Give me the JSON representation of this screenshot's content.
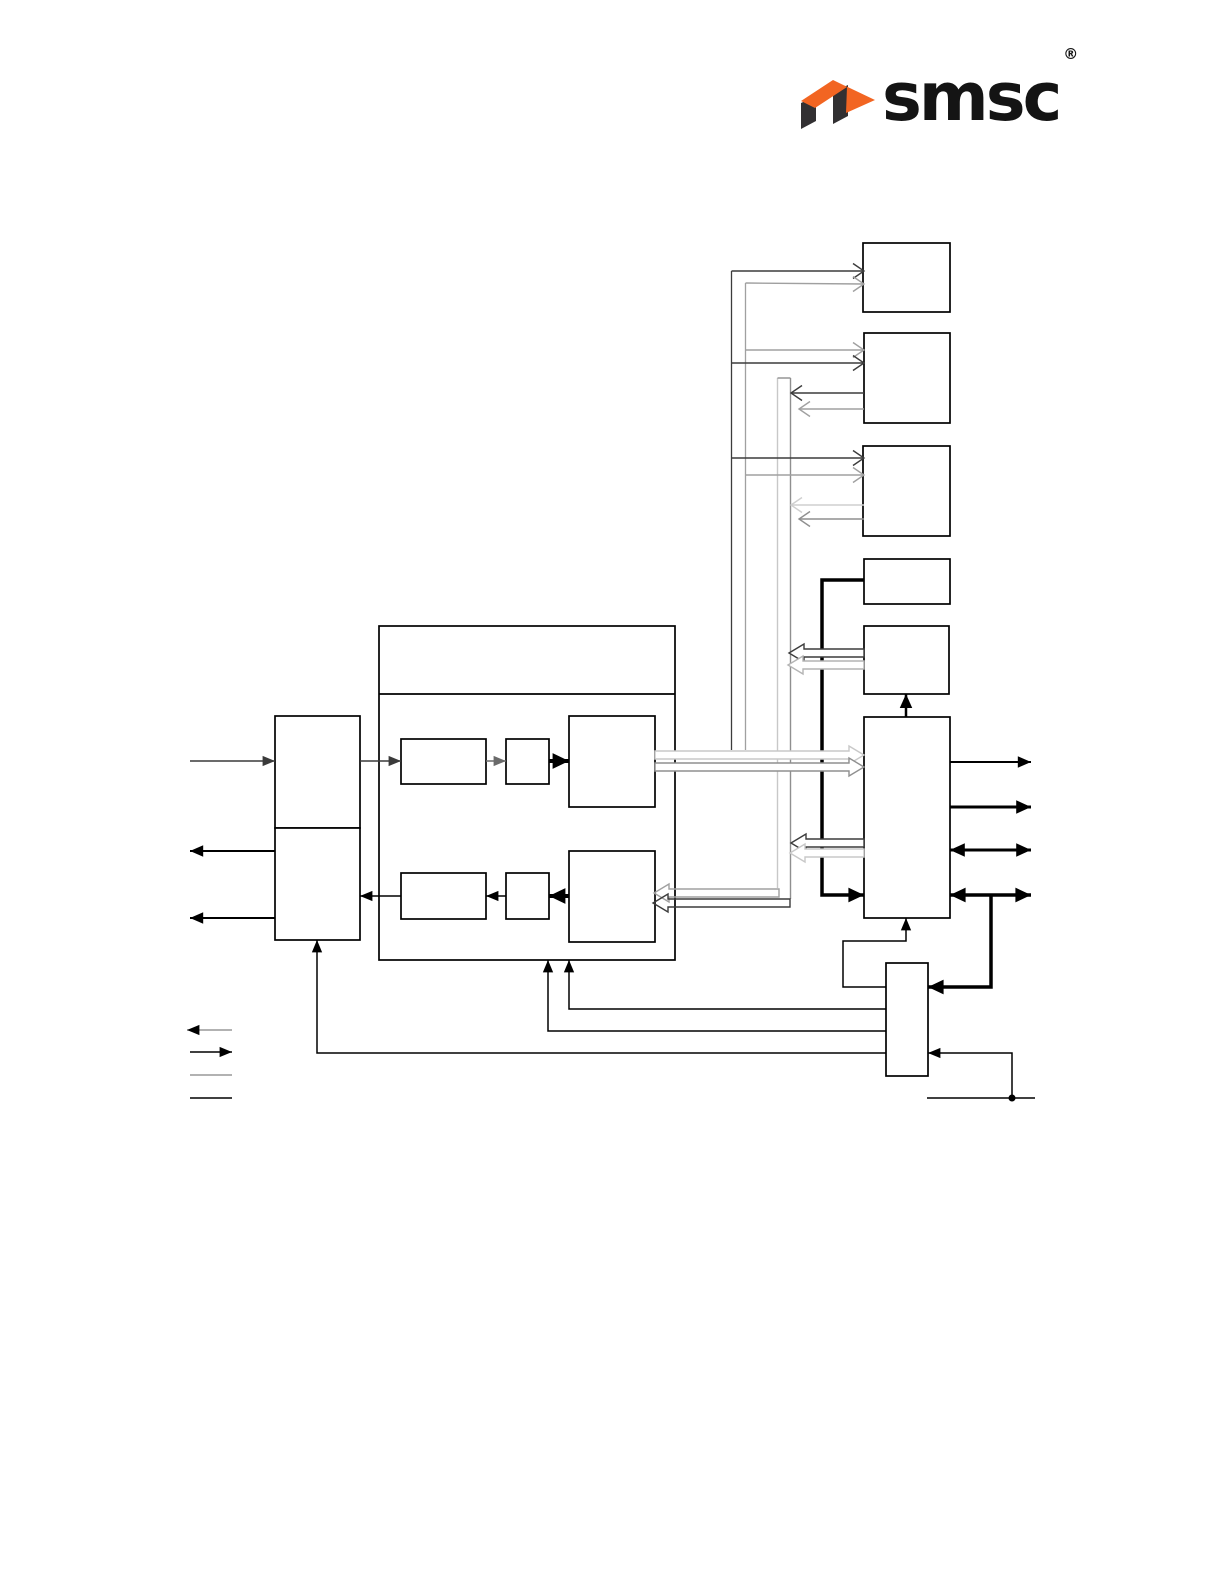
{
  "logo": {
    "text": "smsc",
    "registered": "®",
    "colors": {
      "orange": "#F26522",
      "dark": "#323032",
      "text": "#141414"
    }
  },
  "diagram": {
    "stroke_default": "#000000",
    "boxes": [
      {
        "name": "peripheral-box-1",
        "x": 863,
        "y": 243,
        "w": 87,
        "h": 69
      },
      {
        "name": "peripheral-box-2",
        "x": 864,
        "y": 333,
        "w": 86,
        "h": 90
      },
      {
        "name": "peripheral-box-3",
        "x": 863,
        "y": 446,
        "w": 87,
        "h": 90
      },
      {
        "name": "small-box-1",
        "x": 864,
        "y": 559,
        "w": 86,
        "h": 45
      },
      {
        "name": "small-box-2",
        "x": 864,
        "y": 626,
        "w": 85,
        "h": 68
      },
      {
        "name": "tall-controller-box",
        "x": 864,
        "y": 717,
        "w": 86,
        "h": 201
      },
      {
        "name": "bottom-controller-box",
        "x": 886,
        "y": 963,
        "w": 42,
        "h": 113
      },
      {
        "name": "left-upper-box",
        "x": 275,
        "y": 716,
        "w": 85,
        "h": 112
      },
      {
        "name": "left-lower-box",
        "x": 275,
        "y": 828,
        "w": 85,
        "h": 112
      },
      {
        "name": "center-block",
        "x": 379,
        "y": 626,
        "w": 296,
        "h": 334
      },
      {
        "name": "sub-box-a",
        "x": 401,
        "y": 739,
        "w": 85,
        "h": 45
      },
      {
        "name": "sub-box-b",
        "x": 506,
        "y": 739,
        "w": 43,
        "h": 45
      },
      {
        "name": "sub-box-c",
        "x": 569,
        "y": 716,
        "w": 86,
        "h": 91
      },
      {
        "name": "sub-box-d",
        "x": 401,
        "y": 873,
        "w": 85,
        "h": 46
      },
      {
        "name": "sub-box-e",
        "x": 506,
        "y": 873,
        "w": 43,
        "h": 46
      },
      {
        "name": "sub-box-f",
        "x": 569,
        "y": 851,
        "w": 86,
        "h": 91
      }
    ],
    "lines": [
      {
        "name": "center-title-divider",
        "pts": [
          [
            379,
            694
          ],
          [
            675,
            694
          ]
        ],
        "w": 1.7,
        "head": "none"
      },
      {
        "name": "left-input-arrow",
        "pts": [
          [
            190,
            761
          ],
          [
            275,
            761
          ]
        ],
        "w": 1.5,
        "color": "#3a3a3a",
        "head": "end"
      },
      {
        "name": "left-output-arrow-1",
        "pts": [
          [
            275,
            851
          ],
          [
            190,
            851
          ]
        ],
        "w": 2,
        "head": "end"
      },
      {
        "name": "left-output-arrow-2",
        "pts": [
          [
            275,
            918
          ],
          [
            190,
            918
          ]
        ],
        "w": 2,
        "head": "end"
      },
      {
        "name": "into-sub-a-arrow",
        "pts": [
          [
            360,
            761
          ],
          [
            401,
            761
          ]
        ],
        "w": 1.5,
        "color": "#3a3a3a",
        "head": "end"
      },
      {
        "name": "a-to-b-arrow",
        "pts": [
          [
            486,
            761
          ],
          [
            506,
            761
          ]
        ],
        "w": 1.5,
        "color": "#6a6a6a",
        "head": "end"
      },
      {
        "name": "b-to-c-arrow",
        "pts": [
          [
            549,
            761
          ],
          [
            569,
            761
          ]
        ],
        "w": 4,
        "head": "end"
      },
      {
        "name": "f-to-e-arrow",
        "pts": [
          [
            569,
            896
          ],
          [
            549,
            896
          ]
        ],
        "w": 4,
        "head": "end"
      },
      {
        "name": "e-to-d-arrow",
        "pts": [
          [
            506,
            896
          ],
          [
            486,
            896
          ]
        ],
        "w": 1.5,
        "head": "end"
      },
      {
        "name": "d-to-left-lower-arrow",
        "pts": [
          [
            401,
            896
          ],
          [
            360,
            896
          ]
        ],
        "w": 1.5,
        "head": "end"
      },
      {
        "name": "thick-feed-line",
        "pts": [
          [
            864,
            580
          ],
          [
            822,
            580
          ],
          [
            822,
            895
          ],
          [
            864,
            895
          ]
        ],
        "w": 3.5,
        "head": "end"
      },
      {
        "name": "tall-to-small-box-2-arrow",
        "pts": [
          [
            906,
            717
          ],
          [
            906,
            694
          ]
        ],
        "w": 2.5,
        "head": "end"
      },
      {
        "name": "bottom-to-tall-feed",
        "pts": [
          [
            886,
            987
          ],
          [
            843,
            987
          ],
          [
            843,
            941
          ],
          [
            906,
            941
          ],
          [
            906,
            918
          ]
        ],
        "w": 1.5,
        "head": "end"
      },
      {
        "name": "bottom-to-center-feed-1",
        "pts": [
          [
            886,
            1009
          ],
          [
            569,
            1009
          ],
          [
            569,
            960
          ]
        ],
        "w": 1.5,
        "head": "end"
      },
      {
        "name": "bottom-to-center-feed-2",
        "pts": [
          [
            886,
            1031
          ],
          [
            548,
            1031
          ],
          [
            548,
            960
          ]
        ],
        "w": 1.5,
        "head": "end"
      },
      {
        "name": "bottom-to-left-lower-feed",
        "pts": [
          [
            886,
            1053
          ],
          [
            317,
            1053
          ],
          [
            317,
            940
          ]
        ],
        "w": 1.5,
        "head": "end"
      },
      {
        "name": "right-output-arrow-1",
        "pts": [
          [
            950,
            762
          ],
          [
            1031,
            762
          ]
        ],
        "w": 2,
        "head": "end"
      },
      {
        "name": "right-output-arrow-2",
        "pts": [
          [
            950,
            807
          ],
          [
            1031,
            807
          ]
        ],
        "w": 3,
        "head": "end"
      },
      {
        "name": "right-bidir-arrow-1",
        "pts": [
          [
            950,
            850
          ],
          [
            1031,
            850
          ]
        ],
        "w": 3,
        "head": "both"
      },
      {
        "name": "right-bidir-arrow-2",
        "pts": [
          [
            950,
            895
          ],
          [
            1031,
            895
          ]
        ],
        "w": 3.5,
        "head": "both"
      },
      {
        "name": "bidir-drop-to-bottom-box",
        "pts": [
          [
            991,
            895
          ],
          [
            991,
            987
          ],
          [
            928,
            987
          ]
        ],
        "w": 3.5,
        "head": "end"
      },
      {
        "name": "stub-riser-arrow",
        "pts": [
          [
            1012,
            1098
          ],
          [
            1012,
            1053
          ],
          [
            928,
            1053
          ]
        ],
        "w": 1.5,
        "head": "end"
      },
      {
        "name": "bottom-stub-line",
        "pts": [
          [
            927,
            1098
          ],
          [
            1035,
            1098
          ]
        ],
        "w": 1.5,
        "head": "none"
      },
      {
        "name": "bus-up-dark-vertical",
        "pts": [
          [
            731.5,
            271
          ],
          [
            731.5,
            750
          ]
        ],
        "w": 1.3,
        "color": "#3c3c3c",
        "head": "none"
      },
      {
        "name": "bus-up-gray-vertical",
        "pts": [
          [
            745.5,
            283
          ],
          [
            745.5,
            750
          ]
        ],
        "w": 1.3,
        "color": "#a0a0a0",
        "head": "none"
      },
      {
        "name": "legend-line-1",
        "pts": [
          [
            232,
            1030
          ],
          [
            187,
            1030
          ]
        ],
        "w": 1.5,
        "color": "#999999",
        "head": "end",
        "head_color": "#000000"
      },
      {
        "name": "legend-line-2",
        "pts": [
          [
            190,
            1052
          ],
          [
            232,
            1052
          ]
        ],
        "w": 1.5,
        "head": "end"
      },
      {
        "name": "legend-line-3",
        "pts": [
          [
            190,
            1075
          ],
          [
            232,
            1075
          ]
        ],
        "w": 1.5,
        "color": "#999999",
        "head": "none"
      },
      {
        "name": "legend-line-4",
        "pts": [
          [
            190,
            1098
          ],
          [
            232,
            1098
          ]
        ],
        "w": 1.5,
        "head": "none"
      }
    ],
    "bus": {
      "name": "vertical-bus",
      "x1": 777.5,
      "x2": 790.5,
      "top": 378,
      "bottom_left": 888,
      "bottom_right": 899,
      "left_color": "#c8c8c8",
      "right_color": "#8f8f8f",
      "fill": "#ffffff"
    },
    "hollow_arrows": [
      {
        "name": "c-to-tall-hollow-light",
        "tail": [
          655,
          755
        ],
        "tip": [
          864,
          755
        ],
        "color": "#c8c8c8",
        "fill": "#ffffff"
      },
      {
        "name": "c-to-tall-hollow-gray",
        "tail": [
          655,
          767
        ],
        "tip": [
          864,
          767
        ],
        "color": "#8f8f8f",
        "fill": "#ffffff"
      },
      {
        "name": "small-box-2-in-hollow-dark",
        "tail": [
          864,
          653
        ],
        "tip": [
          789,
          653
        ],
        "color": "#3c3c3c",
        "fill": "#ffffff"
      },
      {
        "name": "small-box-2-in-hollow-gray",
        "tail": [
          864,
          665
        ],
        "tip": [
          788,
          665
        ],
        "color": "#b4b4b4",
        "fill": "#ffffff"
      },
      {
        "name": "tall-to-bus-hollow-dark",
        "tail": [
          864,
          843
        ],
        "tip": [
          791,
          843
        ],
        "color": "#3c3c3c",
        "fill": "#ffffff"
      },
      {
        "name": "tall-to-bus-hollow-light",
        "tail": [
          864,
          853
        ],
        "tip": [
          790,
          853
        ],
        "color": "#c8c8c8",
        "fill": "#ffffff"
      },
      {
        "name": "bus-to-f-hollow-gray",
        "tail": [
          779,
          893
        ],
        "tip": [
          654,
          893
        ],
        "color": "#a0a0a0",
        "fill": "none"
      },
      {
        "name": "bus-to-f-hollow-dark",
        "tail": [
          790,
          903
        ],
        "tip": [
          653,
          903
        ],
        "color": "#3c3c3c",
        "fill": "none"
      }
    ],
    "chevron_arrows": [
      {
        "name": "box1-in-chevron-dark",
        "tail": [
          731.5,
          271
        ],
        "tip": [
          864,
          271
        ],
        "color": "#3c3c3c"
      },
      {
        "name": "box1-in-chevron-gray",
        "tail": [
          745.5,
          283
        ],
        "tip": [
          864,
          284
        ],
        "color": "#a0a0a0"
      },
      {
        "name": "box2-in-chevron-gray",
        "tail": [
          745.5,
          350
        ],
        "tip": [
          864,
          350
        ],
        "color": "#a0a0a0"
      },
      {
        "name": "box2-in-chevron-dark",
        "tail": [
          731.5,
          363
        ],
        "tip": [
          864,
          363
        ],
        "color": "#3c3c3c"
      },
      {
        "name": "box2-out-chevron-dark",
        "tail": [
          864,
          393
        ],
        "tip": [
          791,
          393
        ],
        "color": "#3c3c3c"
      },
      {
        "name": "box2-out-chevron-gray",
        "tail": [
          864,
          409
        ],
        "tip": [
          799,
          409
        ],
        "color": "#a0a0a0"
      },
      {
        "name": "box3-in-chevron-dark",
        "tail": [
          731.5,
          458
        ],
        "tip": [
          864,
          458
        ],
        "color": "#3c3c3c"
      },
      {
        "name": "box3-in-chevron-gray",
        "tail": [
          745.5,
          475
        ],
        "tip": [
          864,
          475
        ],
        "color": "#a0a0a0"
      },
      {
        "name": "box3-out-chevron-light",
        "tail": [
          864,
          505
        ],
        "tip": [
          791,
          505
        ],
        "color": "#cfcfcf"
      },
      {
        "name": "box3-out-chevron-gray",
        "tail": [
          864,
          519
        ],
        "tip": [
          799,
          519
        ],
        "color": "#8f8f8f"
      }
    ],
    "junction_dot": {
      "name": "stub-junction-dot",
      "x": 1012,
      "y": 1098,
      "r": 3.5
    }
  }
}
